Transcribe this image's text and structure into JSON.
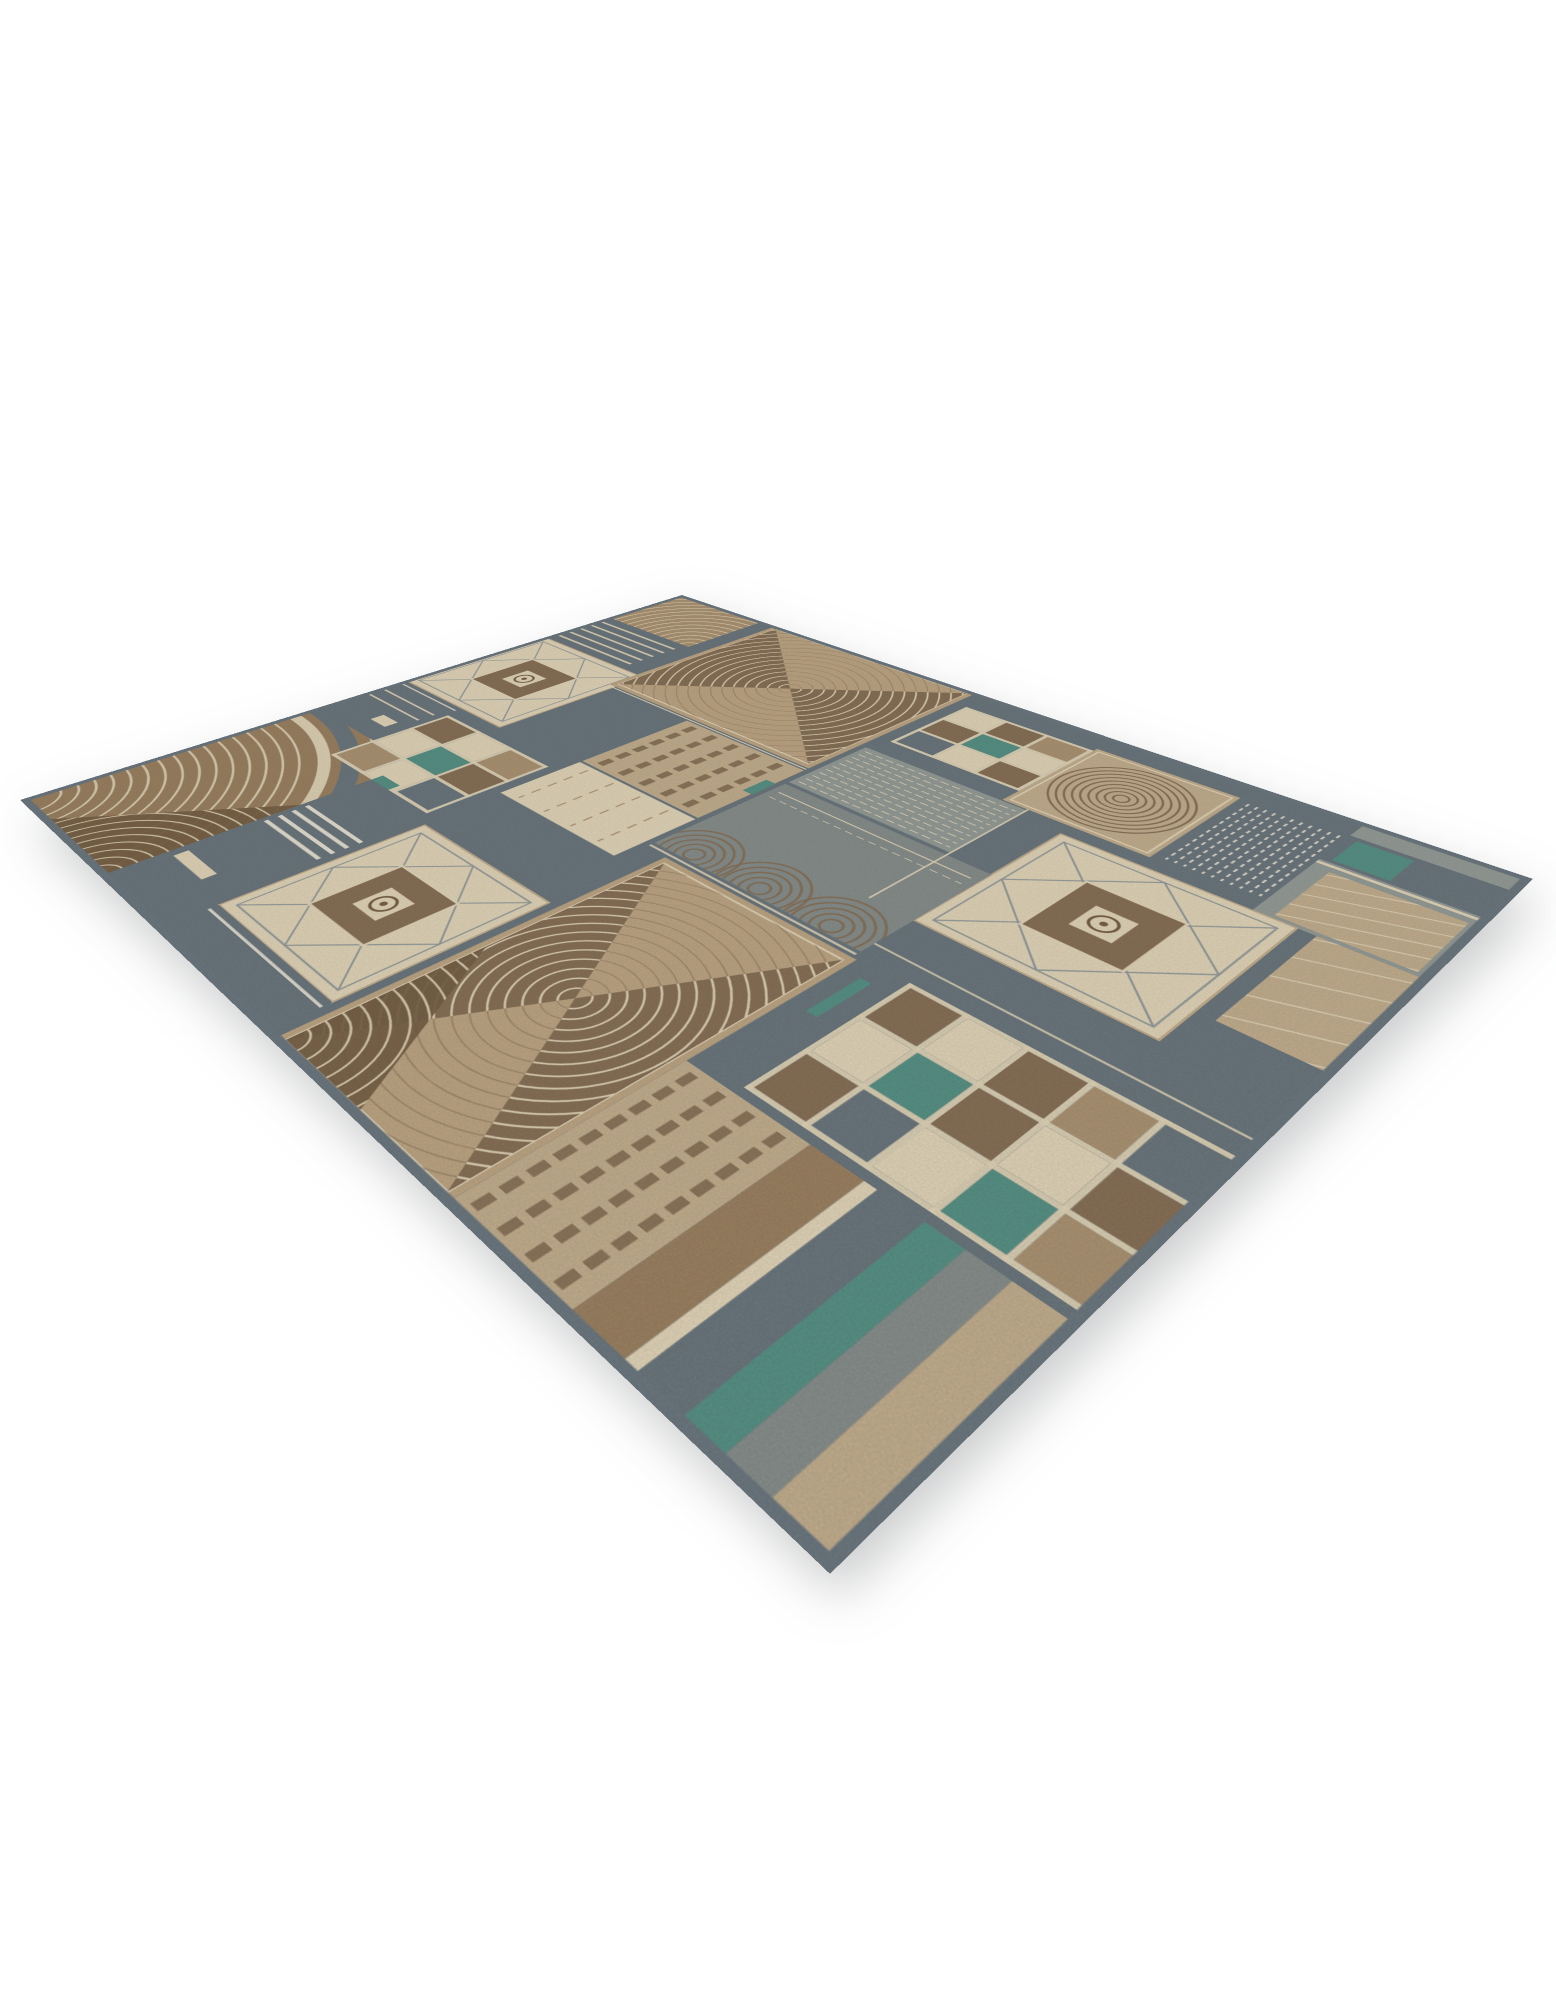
{
  "meta": {
    "description": "Angled product photograph of a rectangular patchwork-style area rug on a plain white background. The rug mixes slate gray, taupe, tan, beige, cream and teal blocks with diamond medallions, checkerboard grids, striped panels and concentric fan motifs.",
    "page_background": "#ffffff"
  },
  "palette": {
    "slate": "#6f7b82",
    "slateDark": "#707c84",
    "warmGray": "#9aa19c",
    "grayGreen": "#8c9390",
    "tan": "#b19877",
    "camel": "#c3ab88",
    "beige": "#c9b493",
    "cream": "#e8dbbe",
    "white": "#f2ecdc",
    "brown": "#8c745a",
    "clay": "#a08565",
    "darkBrown": "#7b6449",
    "teal": "#5b968a",
    "edge": "#98a0a0"
  },
  "rug": {
    "canvas": {
      "w": 1000,
      "h": 800
    },
    "binding_color": "slateDark",
    "tiles": [
      {
        "name": "fan-corner-nw",
        "type": "fan_corner",
        "x": 0,
        "y": 0,
        "w": 145,
        "h": 118,
        "bg": "tan",
        "arc": "cream"
      },
      {
        "name": "stripes-west",
        "type": "hlines",
        "x": 0,
        "y": 122,
        "w": 145,
        "h": 88,
        "bg": "slate",
        "n": 5,
        "color": "cream",
        "lw": 3.5,
        "pad": 12,
        "gap": 16
      },
      {
        "name": "medallion-1",
        "type": "medallion",
        "x": 0,
        "y": 214,
        "w": 178,
        "h": 186,
        "bg": "cream",
        "line": "edge",
        "inner": "brown",
        "accent": "darkBrown"
      },
      {
        "name": "gray-gap-west",
        "type": "hlines",
        "x": 0,
        "y": 404,
        "w": 110,
        "h": 98,
        "bg": "slate",
        "n": 2,
        "color": "cream",
        "lw": 2.5,
        "pad": 26,
        "gap": 18,
        "rects": [
          {
            "x": 66,
            "y": 62,
            "w": 28,
            "h": 15,
            "fill": "cream"
          }
        ]
      },
      {
        "name": "leaf-sw",
        "type": "leaf",
        "x": 0,
        "y": 506,
        "w": 192,
        "h": 294,
        "bg": "clay",
        "arc": "cream",
        "dark": "darkBrown"
      },
      {
        "name": "bowtie-1",
        "type": "bowtie",
        "x": 168,
        "y": 0,
        "w": 295,
        "h": 252,
        "bg": "camel",
        "fan": "brown",
        "arc": "cream"
      },
      {
        "name": "checker-small-west",
        "type": "checker",
        "x": 115,
        "y": 420,
        "w": 172,
        "h": 132,
        "bg": "slate",
        "line": "cream",
        "lw": 4,
        "cells": [
          [
            "b",
            "c",
            "t"
          ],
          [
            "c",
            "e",
            "b"
          ],
          [
            "t",
            "c",
            "s"
          ]
        ]
      },
      {
        "name": "column-stripes-north",
        "type": "vlines",
        "x": 300,
        "y": 258,
        "w": 163,
        "h": 132,
        "bg": "beige",
        "n": 5,
        "color": "brown",
        "lw": 9,
        "dash": "14 7",
        "pad": 18,
        "gap": 30
      },
      {
        "name": "checker-north",
        "type": "checker",
        "x": 478,
        "y": 36,
        "w": 150,
        "h": 118,
        "bg": "slate",
        "line": "cream",
        "lw": 4,
        "cells": [
          [
            "c",
            "b",
            "t"
          ],
          [
            "b",
            "e",
            "c"
          ],
          [
            "s",
            "c",
            "b"
          ]
        ]
      },
      {
        "name": "swirl-north",
        "type": "swirl",
        "x": 628,
        "y": 30,
        "w": 145,
        "h": 148,
        "bg": "beige",
        "arc": "brown",
        "ring": "cream"
      },
      {
        "name": "rain-northeast",
        "type": "vlines",
        "x": 778,
        "y": 30,
        "w": 92,
        "h": 148,
        "bg": "slate",
        "n": 11,
        "color": "white",
        "lw": 1.8,
        "dash": "6 5",
        "pad": 6,
        "gap": 8
      },
      {
        "name": "corner-ne",
        "type": "solid",
        "x": 870,
        "y": 0,
        "w": 130,
        "h": 195,
        "bg": "warmGray",
        "rects": [
          {
            "x": 0,
            "y": 30,
            "w": 130,
            "h": 55,
            "fill": "slate"
          },
          {
            "x": 8,
            "y": 36,
            "w": 46,
            "h": 44,
            "fill": "teal"
          },
          {
            "x": 0,
            "y": 88,
            "w": 130,
            "h": 4,
            "fill": "cream"
          }
        ]
      },
      {
        "name": "diag-ne",
        "type": "diag",
        "x": 885,
        "y": 100,
        "w": 105,
        "h": 90,
        "bg": "beige",
        "color": "cream",
        "n": 6
      },
      {
        "name": "ripple-center",
        "type": "hlines",
        "x": 470,
        "y": 180,
        "w": 185,
        "h": 105,
        "bg": "warmGray",
        "n": 11,
        "color": "cream",
        "lw": 1.4,
        "dash": "9 4",
        "pad": 8,
        "gap": 9
      },
      {
        "name": "medallion-3",
        "type": "medallion",
        "x": 700,
        "y": 195,
        "w": 205,
        "h": 190,
        "bg": "cream",
        "line": "edge",
        "inner": "brown",
        "accent": "darkBrown"
      },
      {
        "name": "edge-east",
        "type": "diag",
        "x": 920,
        "y": 195,
        "w": 80,
        "h": 145,
        "bg": "beige",
        "color": "cream",
        "n": 6
      },
      {
        "name": "fans-row",
        "type": "fans_row",
        "x": 470,
        "y": 290,
        "w": 230,
        "h": 155,
        "bg": "grayGreen",
        "arc": "brown",
        "n": 3
      },
      {
        "name": "cream-band",
        "type": "vlines",
        "x": 300,
        "y": 393,
        "w": 163,
        "h": 90,
        "bg": "cream",
        "n": 4,
        "color": "tan",
        "lw": 2,
        "dash": "10 8",
        "pad": 20,
        "gap": 38
      },
      {
        "name": "checker-big",
        "type": "checker",
        "x": 750,
        "y": 450,
        "w": 250,
        "h": 160,
        "bg": "slate",
        "line": "cream",
        "lw": 4.5,
        "cells": [
          [
            "b",
            "c",
            "b",
            "t",
            "s"
          ],
          [
            "c",
            "e",
            "b",
            "c",
            "b"
          ],
          [
            "b",
            "s",
            "c",
            "e",
            "t"
          ]
        ]
      },
      {
        "name": "medallion-2",
        "type": "medallion",
        "x": 305,
        "y": 565,
        "w": 180,
        "h": 185,
        "bg": "cream",
        "line": "edge",
        "inner": "brown",
        "accent": "darkBrown"
      },
      {
        "name": "stripes-south",
        "type": "hlines",
        "x": 192,
        "y": 560,
        "w": 108,
        "h": 240,
        "bg": "slate",
        "n": 4,
        "color": "white",
        "lw": 4,
        "pad": 60,
        "gap": 13,
        "rects": [
          {
            "x": 10,
            "y": 170,
            "w": 55,
            "h": 13,
            "fill": "cream"
          }
        ]
      },
      {
        "name": "bowtie-2",
        "type": "bowtie",
        "x": 495,
        "y": 455,
        "w": 210,
        "h": 345,
        "bg": "camel",
        "fan": "brown",
        "arc": "cream",
        "dark": "darkBrown"
      },
      {
        "name": "column-stripes-south",
        "type": "vlines",
        "x": 705,
        "y": 618,
        "w": 110,
        "h": 182,
        "bg": "beige",
        "n": 4,
        "color": "brown",
        "lw": 8,
        "dash": "13 6",
        "pad": 14,
        "gap": 26
      },
      {
        "name": "bands-se",
        "type": "bands_v",
        "x": 815,
        "y": 618,
        "w": 185,
        "h": 182,
        "strips": [
          {
            "w": 42,
            "c": "clay"
          },
          {
            "w": 10,
            "c": "cream"
          },
          {
            "w": 34,
            "c": "slate"
          },
          {
            "w": 28,
            "c": "teal"
          },
          {
            "w": 30,
            "c": "grayGreen"
          },
          {
            "w": 41,
            "c": "beige"
          }
        ]
      },
      {
        "name": "south-gap",
        "type": "solid",
        "x": 305,
        "y": 750,
        "w": 180,
        "h": 50,
        "bg": "slate"
      }
    ],
    "accent_lines": [
      {
        "x1": 170,
        "y1": 255,
        "x2": 463,
        "y2": 255,
        "c": "cream",
        "lw": 2
      },
      {
        "x1": 470,
        "y1": 450,
        "x2": 700,
        "y2": 450,
        "c": "cream",
        "lw": 2.5
      },
      {
        "x1": 0,
        "y1": 408,
        "x2": 110,
        "y2": 408,
        "c": "white",
        "lw": 2
      },
      {
        "x1": 655,
        "y1": 178,
        "x2": 655,
        "y2": 385,
        "c": "cream",
        "lw": 2
      },
      {
        "x1": 305,
        "y1": 758,
        "x2": 485,
        "y2": 758,
        "c": "white",
        "lw": 2.5
      },
      {
        "x1": 700,
        "y1": 430,
        "x2": 1000,
        "y2": 430,
        "c": "cream",
        "lw": 2
      }
    ],
    "accent_rects": [
      {
        "x": 452,
        "y": 296,
        "w": 12,
        "h": 30,
        "c": "teal"
      },
      {
        "x": 192,
        "y": 540,
        "w": 30,
        "h": 12,
        "c": "teal"
      },
      {
        "x": 722,
        "y": 470,
        "w": 10,
        "h": 55,
        "c": "teal"
      }
    ]
  }
}
